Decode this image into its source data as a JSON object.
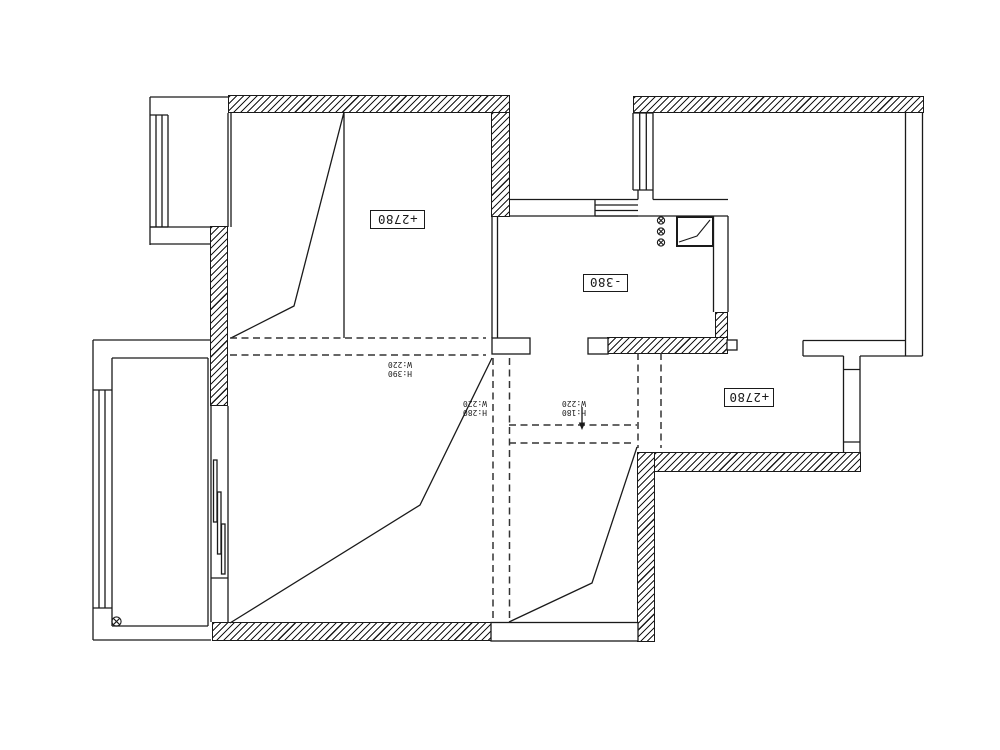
{
  "canvas": {
    "background": "#ffffff",
    "line_color": "#1a1a1a"
  },
  "plan": {
    "room_labels": [
      {
        "id": "upper-left-room",
        "text": "+2780"
      },
      {
        "id": "middle-room",
        "text": "-380"
      },
      {
        "id": "right-room",
        "text": "+2780"
      }
    ],
    "dimension_labels": [
      {
        "id": "left-ridge",
        "height": "H:390",
        "width": "W:220"
      },
      {
        "id": "left-slope",
        "height": "H:280",
        "width": "W:220"
      },
      {
        "id": "middle-passage",
        "height": "H:180",
        "width": "W:220"
      }
    ]
  }
}
